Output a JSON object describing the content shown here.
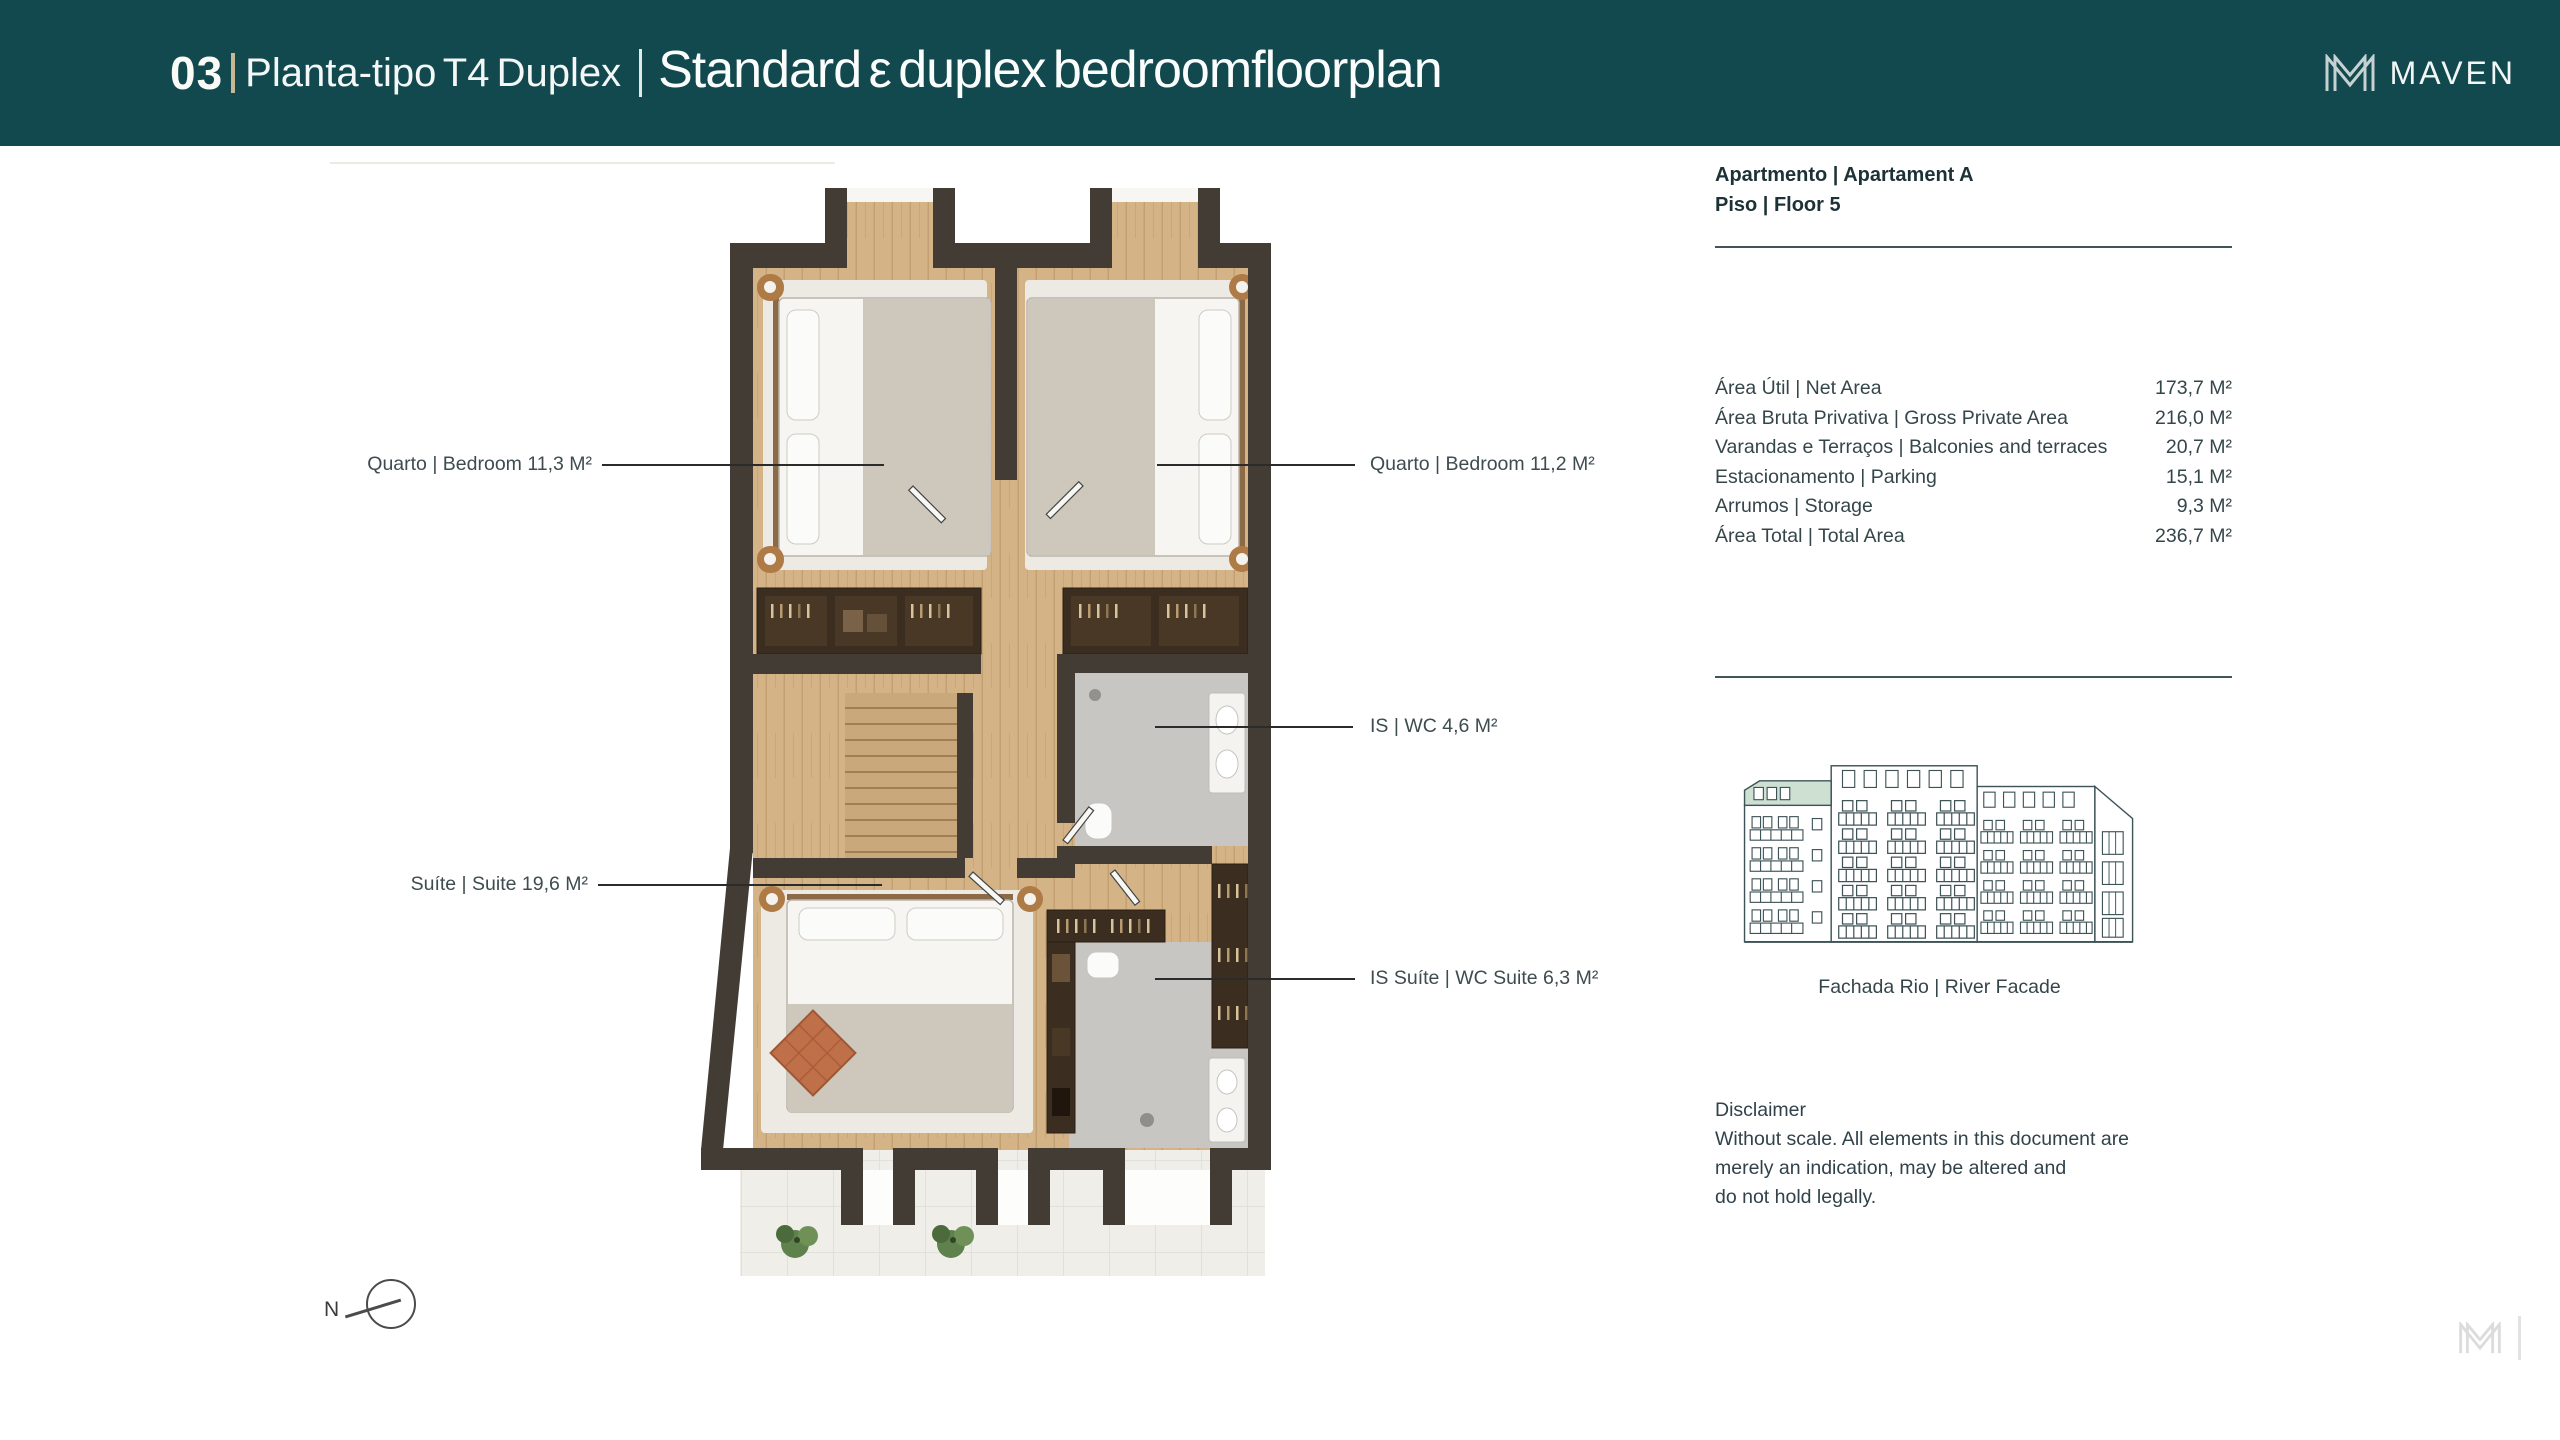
{
  "page": {
    "background": "#FFFFFF"
  },
  "header": {
    "background": "#11494F",
    "slide_number": "03",
    "title_pt": "Planta-tipo T4 Duplex",
    "title_en": "Standard ε duplex bedroomfloorplan",
    "brand": "MAVEN",
    "divider_color": "#C8B795"
  },
  "floorplan": {
    "compass_label": "N",
    "labels": [
      {
        "text": "Quarto | Bedroom 11,3 M²"
      },
      {
        "text": "Quarto | Bedroom 11,2 M²"
      },
      {
        "text": "IS | WC 4,6 M²"
      },
      {
        "text": "Suíte | Suite 19,6 M²"
      },
      {
        "text": "IS Suíte | WC Suite 6,3 M²"
      }
    ]
  },
  "details": {
    "apartment": "Apartmento | Apartament A",
    "floor": "Piso | Floor 5",
    "areas": [
      {
        "label": "Área Útil | Net Area",
        "value": "173,7 M²"
      },
      {
        "label": "Área Bruta Privativa | Gross Private Area",
        "value": "216,0 M²"
      },
      {
        "label": "Varandas e Terraços | Balconies and terraces",
        "value": "20,7 M²"
      },
      {
        "label": "Estacionamento | Parking",
        "value": "15,1 M²"
      },
      {
        "label": "Arrumos | Storage",
        "value": "9,3 M²"
      },
      {
        "label": "Área Total | Total Area",
        "value": "236,7 M²"
      }
    ],
    "facade_caption": "Fachada Rio | River Facade",
    "disclaimer": {
      "title": "Disclaimer",
      "lines": [
        "Without scale. All elements in this document are",
        "merely an indication, may be altered and",
        "do not hold legally."
      ]
    }
  },
  "colors": {
    "wall": "#433C35",
    "wood": "#D4B486",
    "bathroom_floor": "#C7C6C2",
    "rug": "#EDEAE3",
    "facade_stroke": "#3E5357",
    "facade_highlight": "#CEE0D2",
    "label_text": "#3E4C4F",
    "panel_text": "#35464B"
  }
}
